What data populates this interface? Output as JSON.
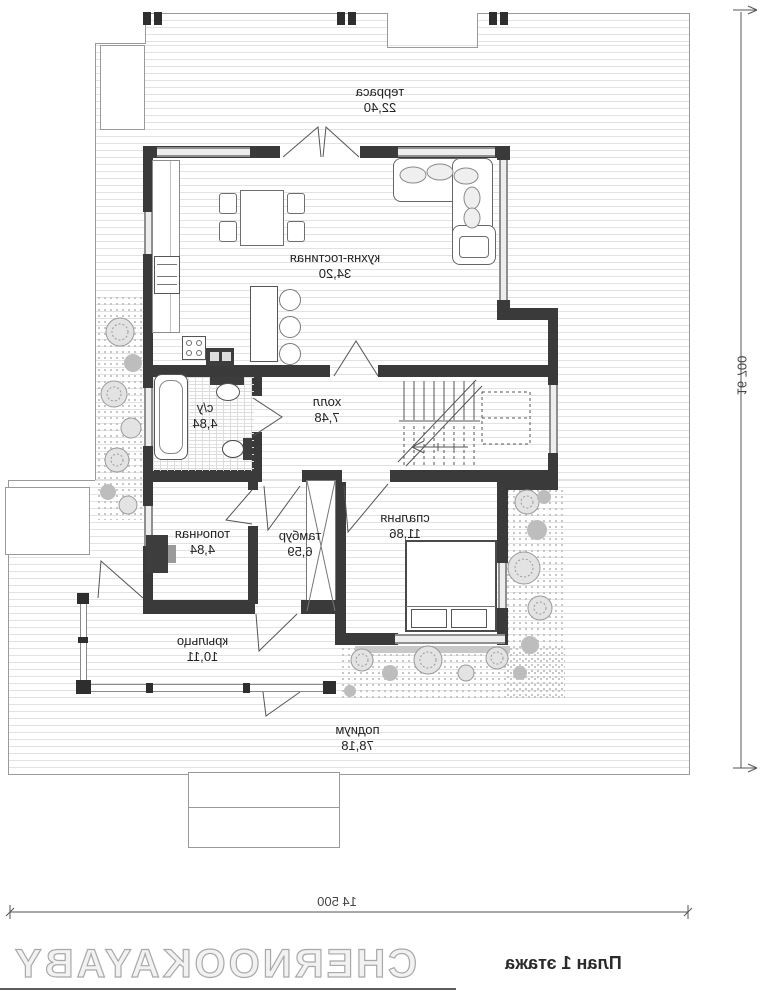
{
  "plan": {
    "title": "План 1 этажа",
    "watermark": "CHERNOOKAYABY",
    "dimensions": {
      "right": "16 700",
      "bottom": "14 500"
    },
    "rooms": [
      {
        "id": "terrace",
        "name": "терраса",
        "area": "22,40"
      },
      {
        "id": "kitchen-living",
        "name": "кухня-гостиная",
        "area": "34,20"
      },
      {
        "id": "hall",
        "name": "холл",
        "area": "7,48"
      },
      {
        "id": "bathroom",
        "name": "с/у",
        "area": "4,84"
      },
      {
        "id": "boiler-room",
        "name": "топочная",
        "area": "4,84"
      },
      {
        "id": "vestibule",
        "name": "тамбур",
        "area": "6,59"
      },
      {
        "id": "bedroom",
        "name": "спальня",
        "area": "11,86"
      },
      {
        "id": "porch",
        "name": "крыльцо",
        "area": "10,11"
      },
      {
        "id": "podium",
        "name": "подиум",
        "area": "78,18"
      }
    ],
    "colors": {
      "wall": "#3a3a3a",
      "hatch_line": "#e2e2e2",
      "thin_line": "#8f8f8f"
    }
  }
}
